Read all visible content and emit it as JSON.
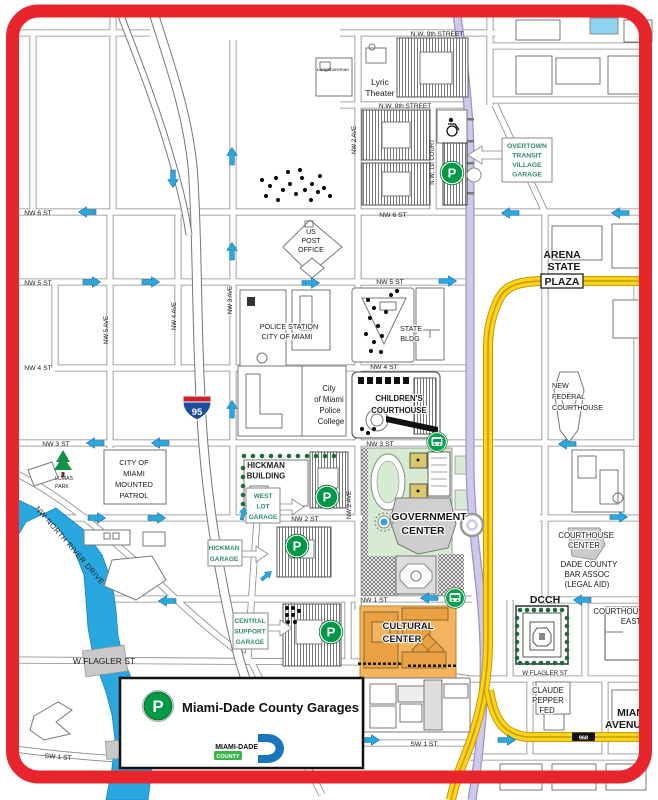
{
  "legend": {
    "title": "Miami-Dade County Garages",
    "marker_letter": "P",
    "logo_line1": "MIAMI-DADE",
    "logo_line2": "COUNTY"
  },
  "interstate_shield": "95",
  "route_shield": "968",
  "parking_letter": "P",
  "colors": {
    "border_red": "#E8252C",
    "water_blue": "#29A8E0",
    "arrow_blue": "#29A8E0",
    "road_yellow": "#FFD21C",
    "metrorail_lavender": "#CFC8EA",
    "garage_green": "#009A47",
    "mover_green": "#00A04C",
    "garage_label_teal": "#2E8B74",
    "government_green": "#D7EAD2",
    "cultural_orange": "#F3B45D"
  },
  "labels": [
    {
      "id": "street-nw9",
      "text": "N.W. 9th STREET",
      "x": 437,
      "y": 36,
      "s": 6.5
    },
    {
      "id": "lyric-theater-1",
      "text": "Lyric",
      "x": 380,
      "y": 85,
      "s": 8.5
    },
    {
      "id": "lyric-theater-2",
      "text": "Theater",
      "x": 380,
      "y": 96,
      "s": 8.5
    },
    {
      "id": "longshoreman",
      "text": "Longshoreman",
      "x": 333,
      "y": 71,
      "s": 4.8
    },
    {
      "id": "street-nw8",
      "text": "N.W. 8th STREET",
      "x": 405,
      "y": 108,
      "s": 6.5
    },
    {
      "id": "ave-nw2-north",
      "text": "NW 2 AVE",
      "x": 356,
      "y": 140,
      "s": 6,
      "r": -90
    },
    {
      "id": "ave-nw1-court",
      "text": "N.W. 1st COURT",
      "x": 434,
      "y": 162,
      "s": 6,
      "r": -90
    },
    {
      "id": "overtown-garage-1",
      "text": "OVERTOWN",
      "x": 527,
      "y": 148,
      "s": 6.8,
      "b": 1,
      "c": "#2E8B74"
    },
    {
      "id": "overtown-garage-2",
      "text": "TRANSIT",
      "x": 527,
      "y": 157.5,
      "s": 6.8,
      "b": 1,
      "c": "#2E8B74"
    },
    {
      "id": "overtown-garage-3",
      "text": "VILLAGE",
      "x": 527,
      "y": 167,
      "s": 6.8,
      "b": 1,
      "c": "#2E8B74"
    },
    {
      "id": "overtown-garage-4",
      "text": "GARAGE",
      "x": 527,
      "y": 176.5,
      "s": 6.8,
      "b": 1,
      "c": "#2E8B74"
    },
    {
      "id": "street-nw6-west",
      "text": "NW 6 ST",
      "x": 38,
      "y": 215,
      "s": 6.8
    },
    {
      "id": "street-nw6-east",
      "text": "NW 6 ST",
      "x": 393,
      "y": 217,
      "s": 6.8
    },
    {
      "id": "street-nw5-west",
      "text": "NW 5 ST",
      "x": 38,
      "y": 285,
      "s": 6.8
    },
    {
      "id": "street-nw5-east",
      "text": "NW 5 ST",
      "x": 390,
      "y": 284,
      "s": 6.8
    },
    {
      "id": "us-post-office-1",
      "text": "US",
      "x": 311,
      "y": 234,
      "s": 7,
      "h": 1
    },
    {
      "id": "us-post-office-2",
      "text": "POST",
      "x": 311,
      "y": 243,
      "s": 7,
      "h": 1
    },
    {
      "id": "us-post-office-3",
      "text": "OFFICE",
      "x": 311,
      "y": 252,
      "s": 7,
      "h": 1
    },
    {
      "id": "arena",
      "text": "ARENA",
      "x": 562,
      "y": 258,
      "s": 10.5,
      "b": 1
    },
    {
      "id": "state-plaza",
      "text": "STATE",
      "x": 564,
      "y": 270,
      "s": 10.5,
      "b": 1
    },
    {
      "id": "plaza",
      "text": "PLAZA",
      "x": 562,
      "y": 285,
      "s": 10.5,
      "b": 1
    },
    {
      "id": "ave-nw5",
      "text": "NW 5 AVE",
      "x": 108,
      "y": 330,
      "s": 6,
      "r": -90
    },
    {
      "id": "ave-nw4",
      "text": "NW 4 AVE",
      "x": 176,
      "y": 316,
      "s": 6,
      "r": -90
    },
    {
      "id": "ave-nw3",
      "text": "NW 3 AVE",
      "x": 232,
      "y": 300,
      "s": 6,
      "r": -90
    },
    {
      "id": "police-station-1",
      "text": "POLICE STATION",
      "x": 289,
      "y": 329,
      "s": 7.2,
      "h": 1
    },
    {
      "id": "police-station-2",
      "text": "CITY OF MIAMI",
      "x": 287,
      "y": 339,
      "s": 7.2,
      "h": 1
    },
    {
      "id": "state-bldg-1",
      "text": "STATE",
      "x": 411,
      "y": 331,
      "s": 7.2,
      "h": 1
    },
    {
      "id": "state-bldg-2",
      "text": "BLDG",
      "x": 410,
      "y": 341,
      "s": 7.2,
      "h": 1
    },
    {
      "id": "street-nw4-west",
      "text": "NW 4 ST",
      "x": 38,
      "y": 370,
      "s": 6.8
    },
    {
      "id": "street-nw4-east",
      "text": "NW 4 ST",
      "x": 384,
      "y": 369,
      "s": 6.8
    },
    {
      "id": "police-college-1",
      "text": "City",
      "x": 329,
      "y": 391,
      "s": 7.8
    },
    {
      "id": "police-college-2",
      "text": "of Miami",
      "x": 329,
      "y": 402,
      "s": 7.8
    },
    {
      "id": "police-college-3",
      "text": "Police",
      "x": 330,
      "y": 413,
      "s": 7.8
    },
    {
      "id": "police-college-4",
      "text": "College",
      "x": 331,
      "y": 424,
      "s": 7.8
    },
    {
      "id": "childrens-courthouse-1",
      "text": "CHILDREN'S",
      "x": 399,
      "y": 401,
      "s": 7.8,
      "b": 1,
      "h": 1
    },
    {
      "id": "childrens-courthouse-2",
      "text": "COURTHOUSE",
      "x": 399,
      "y": 413,
      "s": 7.8,
      "b": 1,
      "h": 1
    },
    {
      "id": "new-federal-1",
      "text": "NEW",
      "x": 552,
      "y": 388,
      "s": 7.2,
      "a": "start",
      "h": 1
    },
    {
      "id": "new-federal-2",
      "text": "FEDERAL",
      "x": 552,
      "y": 399,
      "s": 7.2,
      "a": "start",
      "h": 1
    },
    {
      "id": "new-federal-3",
      "text": "COURTHOUSE",
      "x": 552,
      "y": 410,
      "s": 7.2,
      "a": "start",
      "h": 1
    },
    {
      "id": "street-nw3-west",
      "text": "NW 3 ST",
      "x": 56,
      "y": 446,
      "s": 6.8
    },
    {
      "id": "street-nw3-east",
      "text": "NW 3 ST",
      "x": 380,
      "y": 446,
      "s": 6.8
    },
    {
      "id": "lumas-park-1",
      "text": "LUMAS",
      "x": 64,
      "y": 480,
      "s": 5.2
    },
    {
      "id": "lumas-park-2",
      "text": "PARK",
      "x": 62,
      "y": 488,
      "s": 5.2
    },
    {
      "id": "mounted-patrol-1",
      "text": "CITY OF",
      "x": 134,
      "y": 465,
      "s": 7.5
    },
    {
      "id": "mounted-patrol-2",
      "text": "MIAMI",
      "x": 134,
      "y": 476,
      "s": 7.5
    },
    {
      "id": "mounted-patrol-3",
      "text": "MOUNTED",
      "x": 134,
      "y": 487,
      "s": 7.5
    },
    {
      "id": "mounted-patrol-4",
      "text": "PATROL",
      "x": 134,
      "y": 498,
      "s": 7.5
    },
    {
      "id": "hickman-building-1",
      "text": "HICKMAN",
      "x": 266,
      "y": 468,
      "s": 8,
      "b": 1,
      "c": "#222",
      "h": 1
    },
    {
      "id": "hickman-building-2",
      "text": "BUILDING",
      "x": 266,
      "y": 478.5,
      "s": 8,
      "b": 1,
      "c": "#222",
      "h": 1
    },
    {
      "id": "west-lot-garage-1",
      "text": "WEST",
      "x": 263,
      "y": 498,
      "s": 6.5,
      "b": 1,
      "c": "#2E8B74"
    },
    {
      "id": "west-lot-garage-2",
      "text": "LOT",
      "x": 263,
      "y": 508.5,
      "s": 6.5,
      "b": 1,
      "c": "#2E8B74"
    },
    {
      "id": "west-lot-garage-3",
      "text": "GARAGE",
      "x": 263,
      "y": 519,
      "s": 6.5,
      "b": 1,
      "c": "#2E8B74"
    },
    {
      "id": "street-nw2",
      "text": "NW 2 ST",
      "x": 305,
      "y": 521,
      "s": 6.8
    },
    {
      "id": "ave-nw2-south",
      "text": "NW 2 AVE",
      "x": 351,
      "y": 505,
      "s": 6,
      "r": -90
    },
    {
      "id": "government-center-1",
      "text": "GOVERNMENT",
      "x": 429,
      "y": 520,
      "s": 10.5,
      "b": 1,
      "h": 1
    },
    {
      "id": "government-center-2",
      "text": "CENTER",
      "x": 423,
      "y": 534,
      "s": 10.5,
      "b": 1,
      "h": 1
    },
    {
      "id": "north-river-drive",
      "text": "NW NORTH RIVER DRIVE",
      "x": 68,
      "y": 547,
      "s": 7.5,
      "r": 49,
      "ls": 0.5
    },
    {
      "id": "miami-river",
      "text": "MIAMI RIVER",
      "x": 50,
      "y": 586,
      "s": 12.5,
      "b": 1,
      "i": 1,
      "c": "#fff",
      "r": 51,
      "ls": 1
    },
    {
      "id": "hickman-garage-1",
      "text": "HICKMAN",
      "x": 224,
      "y": 550,
      "s": 6.5,
      "b": 1,
      "c": "#2E8B74"
    },
    {
      "id": "hickman-garage-2",
      "text": "GARAGE",
      "x": 224,
      "y": 561,
      "s": 6.5,
      "b": 1,
      "c": "#2E8B74"
    },
    {
      "id": "courthouse-center-1",
      "text": "COURTHOUSE",
      "x": 586,
      "y": 538,
      "s": 7.8,
      "h": 1
    },
    {
      "id": "courthouse-center-2",
      "text": "CENTER",
      "x": 584,
      "y": 548,
      "s": 7.8,
      "h": 1
    },
    {
      "id": "bar-assoc-1",
      "text": "DADE COUNTY",
      "x": 589,
      "y": 567,
      "s": 7.8,
      "h": 1
    },
    {
      "id": "bar-assoc-2",
      "text": "BAR ASSOC",
      "x": 587,
      "y": 577,
      "s": 7.8,
      "h": 1
    },
    {
      "id": "bar-assoc-3",
      "text": "(LEGAL AID)",
      "x": 587,
      "y": 587,
      "s": 7.8,
      "h": 1
    },
    {
      "id": "street-nw1",
      "text": "NW 1 ST",
      "x": 374,
      "y": 602,
      "s": 6.8
    },
    {
      "id": "dcch",
      "text": "DCCH",
      "x": 545,
      "y": 603,
      "s": 10.5,
      "b": 1
    },
    {
      "id": "courthouse-east-1",
      "text": "COURTHOUSE",
      "x": 621,
      "y": 614,
      "s": 7.8,
      "h": 1
    },
    {
      "id": "courthouse-east-2",
      "text": "EAST",
      "x": 631,
      "y": 624,
      "s": 7.8,
      "h": 1
    },
    {
      "id": "central-support-1",
      "text": "CENTRAL",
      "x": 250,
      "y": 623,
      "s": 6.5,
      "b": 1,
      "c": "#2E8B74"
    },
    {
      "id": "central-support-2",
      "text": "SUPPORT",
      "x": 250,
      "y": 633.5,
      "s": 6.5,
      "b": 1,
      "c": "#2E8B74"
    },
    {
      "id": "central-support-3",
      "text": "GARAGE",
      "x": 250,
      "y": 644,
      "s": 6.5,
      "b": 1,
      "c": "#2E8B74"
    },
    {
      "id": "cultural-center-1",
      "text": "CULTURAL",
      "x": 408,
      "y": 629,
      "s": 9.5,
      "b": 1,
      "h": 1
    },
    {
      "id": "cultural-center-2",
      "text": "CENTER",
      "x": 402,
      "y": 642,
      "s": 9.5,
      "b": 1,
      "h": 1
    },
    {
      "id": "street-flagler-west",
      "text": "W FLAGLER ST",
      "x": 104,
      "y": 664,
      "s": 8.5
    },
    {
      "id": "street-flagler-east",
      "text": "W FLAGLER ST",
      "x": 545,
      "y": 675,
      "s": 6.2
    },
    {
      "id": "claude-pepper-1",
      "text": "CLAUDE",
      "x": 548,
      "y": 693,
      "s": 7.8,
      "h": 1
    },
    {
      "id": "claude-pepper-2",
      "text": "PEPPER",
      "x": 548,
      "y": 703,
      "s": 7.8,
      "h": 1
    },
    {
      "id": "claude-pepper-3",
      "text": "FED",
      "x": 547,
      "y": 713,
      "s": 7.8,
      "h": 1
    },
    {
      "id": "miami-avenue-1",
      "text": "MIAMI",
      "x": 648,
      "y": 716,
      "s": 10.5,
      "b": 1,
      "a": "end",
      "h": 1
    },
    {
      "id": "miami-avenue-2",
      "text": "AVENUE",
      "x": 648,
      "y": 728,
      "s": 10.5,
      "b": 1,
      "a": "end",
      "h": 1
    },
    {
      "id": "street-sw1-west",
      "text": "SW 1 ST",
      "x": 58,
      "y": 759,
      "s": 6.8,
      "r": 4
    },
    {
      "id": "street-sw1-east",
      "text": "SW 1 ST",
      "x": 424,
      "y": 746,
      "s": 6.8
    }
  ],
  "arrows": [
    {
      "x": 91,
      "y": 282,
      "r": 0
    },
    {
      "x": 150,
      "y": 282,
      "r": 0
    },
    {
      "x": 310,
      "y": 283,
      "r": 0
    },
    {
      "x": 447,
      "y": 281,
      "r": 0
    },
    {
      "x": 96,
      "y": 518,
      "r": 0
    },
    {
      "x": 156,
      "y": 518,
      "r": 0
    },
    {
      "x": 618,
      "y": 517,
      "r": 0
    },
    {
      "x": 370,
      "y": 740,
      "r": 0
    },
    {
      "x": 506,
      "y": 740,
      "r": 0
    },
    {
      "x": 88,
      "y": 212,
      "r": 180
    },
    {
      "x": 511,
      "y": 213,
      "r": 180
    },
    {
      "x": 621,
      "y": 213,
      "r": 180
    },
    {
      "x": 96,
      "y": 443,
      "r": 180
    },
    {
      "x": 161,
      "y": 443,
      "r": 180
    },
    {
      "x": 568,
      "y": 444,
      "r": 180
    },
    {
      "x": 430,
      "y": 598,
      "r": 180
    },
    {
      "x": 583,
      "y": 600,
      "r": 180
    },
    {
      "x": 168,
      "y": 601,
      "r": 180
    },
    {
      "x": 232,
      "y": 157,
      "r": -90
    },
    {
      "x": 232,
      "y": 252,
      "r": -90
    },
    {
      "x": 232,
      "y": 410,
      "r": -90
    },
    {
      "x": 173,
      "y": 178,
      "r": 90
    },
    {
      "x": 243,
      "y": 514,
      "r": -80,
      "s": 0.75
    },
    {
      "x": 266,
      "y": 576,
      "r": -40,
      "s": 0.75
    }
  ],
  "parking_garages": [
    {
      "x": 452,
      "y": 173
    },
    {
      "x": 327,
      "y": 497
    },
    {
      "x": 297,
      "y": 546
    },
    {
      "x": 331,
      "y": 632
    }
  ],
  "mover_stations": [
    {
      "x": 437,
      "y": 442
    },
    {
      "x": 455,
      "y": 598
    }
  ],
  "metrorail_station": {
    "x": 472,
    "y": 525
  }
}
